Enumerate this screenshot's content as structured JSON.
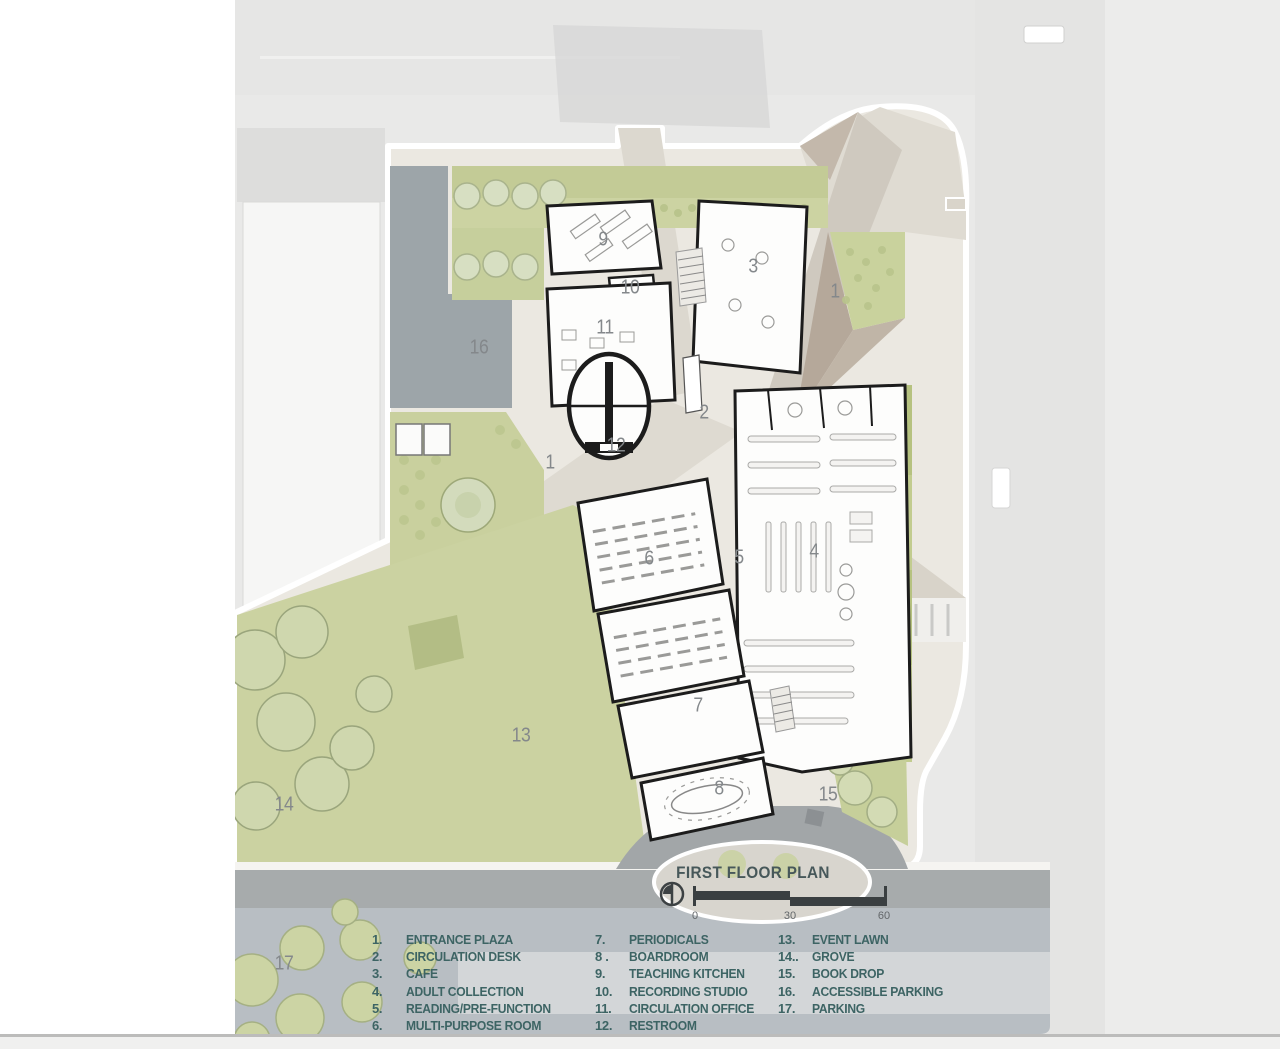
{
  "plan": {
    "title": "FIRST FLOOR PLAN",
    "scale_bar": {
      "ticks": [
        "0",
        "30",
        "60"
      ],
      "tick_x": [
        695,
        790,
        884
      ]
    },
    "labels": [
      {
        "n": "1",
        "x": 835,
        "y": 292
      },
      {
        "n": "1",
        "x": 550,
        "y": 463
      },
      {
        "n": "2",
        "x": 704,
        "y": 413
      },
      {
        "n": "3",
        "x": 753,
        "y": 267
      },
      {
        "n": "4",
        "x": 814,
        "y": 552
      },
      {
        "n": "5",
        "x": 739,
        "y": 558
      },
      {
        "n": "6",
        "x": 649,
        "y": 559
      },
      {
        "n": "7",
        "x": 698,
        "y": 706
      },
      {
        "n": "8",
        "x": 719,
        "y": 789
      },
      {
        "n": "9",
        "x": 603,
        "y": 240
      },
      {
        "n": "10",
        "x": 630,
        "y": 288
      },
      {
        "n": "11",
        "x": 605,
        "y": 328
      },
      {
        "n": "12",
        "x": 616,
        "y": 446
      },
      {
        "n": "13",
        "x": 521,
        "y": 736
      },
      {
        "n": "14",
        "x": 284,
        "y": 805
      },
      {
        "n": "15",
        "x": 828,
        "y": 795
      },
      {
        "n": "16",
        "x": 479,
        "y": 348
      },
      {
        "n": "17",
        "x": 284,
        "y": 964
      }
    ],
    "legend": {
      "columns": [
        {
          "x": 372,
          "items": [
            {
              "num": "1.",
              "label": "ENTRANCE PLAZA"
            },
            {
              "num": "2.",
              "label": "CIRCULATION DESK"
            },
            {
              "num": "3.",
              "label": "CAFE"
            },
            {
              "num": "4.",
              "label": "ADULT COLLECTION"
            },
            {
              "num": "5.",
              "label": "READING/PRE-FUNCTION"
            },
            {
              "num": "6.",
              "label": "MULTI-PURPOSE ROOM"
            }
          ]
        },
        {
          "x": 595,
          "items": [
            {
              "num": "7.",
              "label": "PERIODICALS"
            },
            {
              "num": "8 .",
              "label": "BOARDROOM"
            },
            {
              "num": "9.",
              "label": "TEACHING KITCHEN"
            },
            {
              "num": "10.",
              "label": "RECORDING STUDIO"
            },
            {
              "num": "11.",
              "label": "CIRCULATION OFFICE"
            },
            {
              "num": "12.",
              "label": "RESTROOM"
            }
          ]
        },
        {
          "x": 778,
          "items": [
            {
              "num": "13.",
              "label": "EVENT LAWN"
            },
            {
              "num": "14..",
              "label": "GROVE"
            },
            {
              "num": "15.",
              "label": "BOOK DROP"
            },
            {
              "num": "16.",
              "label": "ACCESSIBLE PARKING"
            },
            {
              "num": "17.",
              "label": "PARKING"
            }
          ]
        }
      ]
    },
    "colors": {
      "lawn_green": "#cbd2a1",
      "planting_green": "#b6c280",
      "paving_beige": "#dcd8cf",
      "plaza_taupe": "#b5a89a",
      "parking_gray": "#9da5a9",
      "road_gray": "#a7abac",
      "legend_band": "#b8bec3",
      "wall_black": "#1c1c1c",
      "legend_text": "#3d6464",
      "label_gray": "#84888b"
    }
  }
}
